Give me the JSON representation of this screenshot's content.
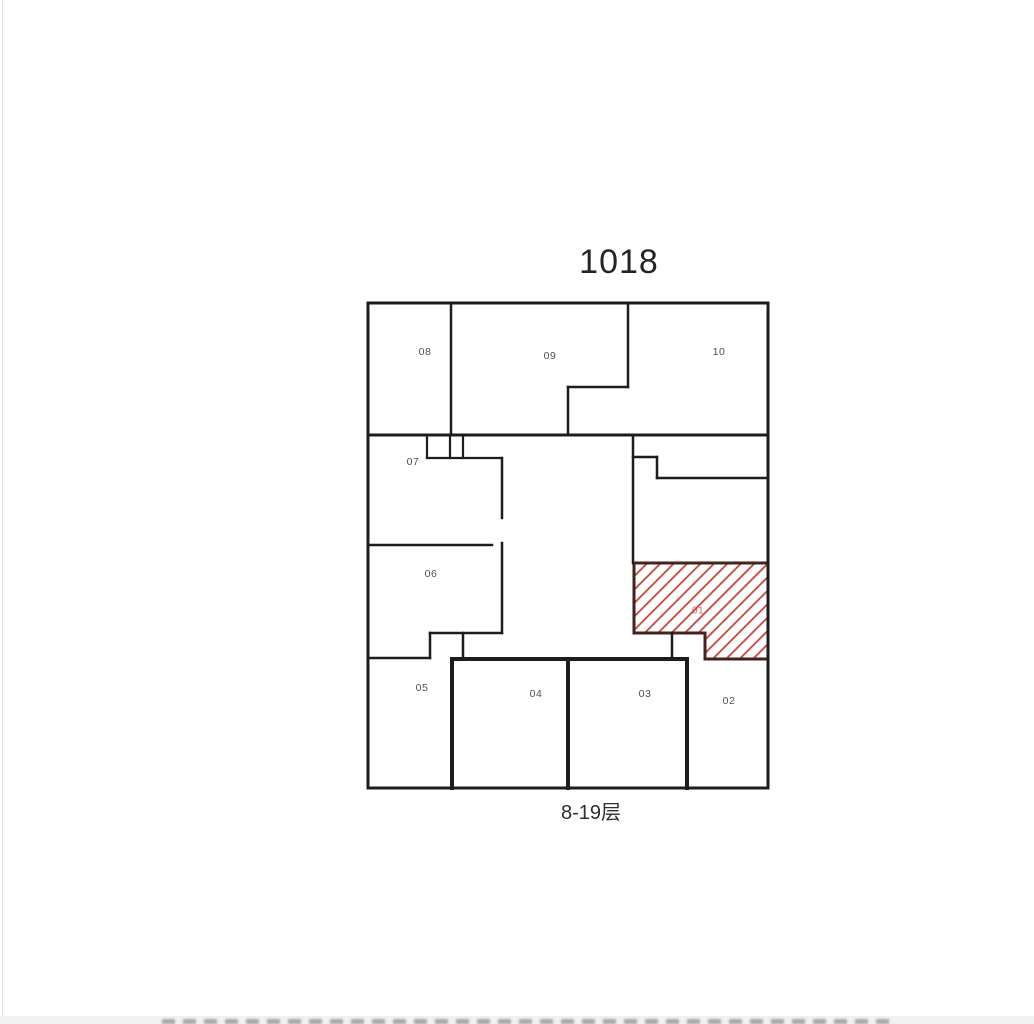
{
  "page": {
    "background": "#ffffff",
    "title": "1018",
    "caption": "8-19层"
  },
  "floorplan": {
    "wall_color": "#1d1d1d",
    "label_color": "#4f4f4f",
    "walls": [
      [
        368,
        303,
        768,
        303,
        3
      ],
      [
        368,
        788,
        768,
        788,
        3
      ],
      [
        368,
        303,
        368,
        788,
        3
      ],
      [
        768,
        303,
        768,
        788,
        3
      ],
      [
        451,
        303,
        451,
        435,
        2.5
      ],
      [
        628,
        303,
        628,
        387,
        2.5
      ],
      [
        568,
        387,
        628,
        387,
        2.5
      ],
      [
        568,
        387,
        568,
        435,
        2.5
      ],
      [
        368,
        435,
        768,
        435,
        3
      ],
      [
        427,
        435,
        427,
        458,
        2.2
      ],
      [
        450,
        435,
        450,
        458,
        2.2
      ],
      [
        463,
        435,
        463,
        458,
        2.2
      ],
      [
        427,
        458,
        502,
        458,
        2.2
      ],
      [
        502,
        458,
        502,
        518,
        2.5
      ],
      [
        502,
        543,
        502,
        633,
        2.5
      ],
      [
        368,
        545,
        492,
        545,
        2.5
      ],
      [
        430,
        633,
        502,
        633,
        2.5
      ],
      [
        430,
        633,
        430,
        658,
        2.5
      ],
      [
        368,
        658,
        430,
        658,
        2.5
      ],
      [
        463,
        633,
        463,
        659,
        2.5
      ],
      [
        633,
        435,
        633,
        563,
        2.5
      ],
      [
        633,
        457,
        657,
        457,
        2.5
      ],
      [
        657,
        457,
        657,
        478,
        2.5
      ],
      [
        657,
        478,
        768,
        478,
        2.5
      ],
      [
        672,
        633,
        672,
        659,
        2.5
      ],
      [
        672,
        659,
        687,
        659,
        2.5
      ],
      [
        452,
        659,
        452,
        788,
        4
      ],
      [
        452,
        659,
        568,
        659,
        4
      ],
      [
        568,
        659,
        568,
        788,
        4
      ],
      [
        568,
        659,
        687,
        659,
        4
      ],
      [
        687,
        659,
        687,
        788,
        4
      ]
    ],
    "rooms": [
      {
        "label": "08",
        "x": 425,
        "y": 352
      },
      {
        "label": "09",
        "x": 550,
        "y": 356
      },
      {
        "label": "10",
        "x": 719,
        "y": 352
      },
      {
        "label": "07",
        "x": 413,
        "y": 462
      },
      {
        "label": "06",
        "x": 431,
        "y": 574
      },
      {
        "label": "05",
        "x": 422,
        "y": 688
      },
      {
        "label": "04",
        "x": 536,
        "y": 694
      },
      {
        "label": "03",
        "x": 645,
        "y": 694
      },
      {
        "label": "02",
        "x": 729,
        "y": 701
      }
    ],
    "highlighted_unit": {
      "label": "01",
      "label_x": 698,
      "label_y": 611,
      "points": "634,563 768,563 768,659 705,659 705,633 634,633",
      "border_color": "#46221d",
      "stripe_color": "#c2473c",
      "label_color": "#b8392e"
    }
  }
}
